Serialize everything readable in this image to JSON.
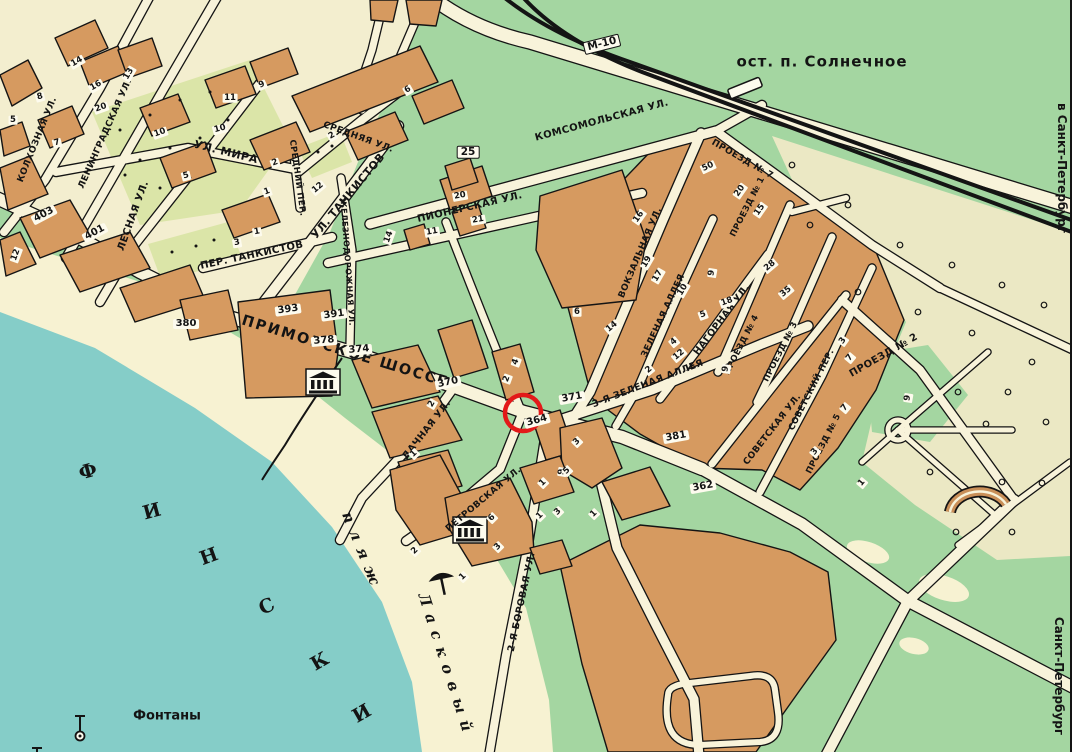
{
  "colors": {
    "land": "#a4d6a1",
    "water": "#85cdc8",
    "beach": "#f7f2d2",
    "road": "#f8f3da",
    "town": "#f3eecf",
    "park": "#ebe8c4",
    "court": "#dbe5a8",
    "building": "#d69a60",
    "outline": "#141414",
    "marker": "#e31919"
  },
  "marker": {
    "x": 523,
    "y": 413,
    "r": 18,
    "stroke_width": 4.5
  },
  "labels": [
    {
      "t": "КОЛХОЗНАЯ УЛ.",
      "x": 38,
      "y": 140,
      "r": -68,
      "st": "st",
      "s": 9
    },
    {
      "t": "ЛЕНИНГРАДСКАЯ УЛ.",
      "x": 106,
      "y": 134,
      "r": -66,
      "st": "st",
      "s": 9
    },
    {
      "t": "ЛЕСНАЯ УЛ.",
      "x": 134,
      "y": 216,
      "r": -70,
      "st": "st"
    },
    {
      "t": "УЛ. МИРА",
      "x": 226,
      "y": 152,
      "r": 14,
      "st": "st",
      "s": 11
    },
    {
      "t": "СРЕДНЯЯ УЛ.",
      "x": 358,
      "y": 138,
      "r": 20,
      "st": "st",
      "s": 9
    },
    {
      "t": "СРЕДНИЙ ПЕР.",
      "x": 297,
      "y": 178,
      "r": 82,
      "st": "st",
      "s": 8.5
    },
    {
      "t": "УЛ. ТАНКИСТОВ",
      "x": 348,
      "y": 196,
      "r": -50,
      "st": "st",
      "s": 11
    },
    {
      "t": "ПЕР. ТАНКИСТОВ",
      "x": 252,
      "y": 256,
      "r": -12,
      "st": "st"
    },
    {
      "t": "ЖЕЛЕЗНОДОРОЖНАЯ УЛ.",
      "x": 347,
      "y": 262,
      "r": 86,
      "st": "st",
      "s": 8
    },
    {
      "t": "КОМСОМОЛЬСКАЯ УЛ.",
      "x": 602,
      "y": 121,
      "r": -15,
      "st": "st"
    },
    {
      "t": "ПИОНЕРСКАЯ УЛ.",
      "x": 470,
      "y": 208,
      "r": -13,
      "st": "st"
    },
    {
      "t": "ВОКЗАЛЬНАЯ УЛ.",
      "x": 641,
      "y": 253,
      "r": -67,
      "st": "st",
      "s": 9
    },
    {
      "t": "ЗЕЛЕНАЯ АЛЛЕЯ",
      "x": 664,
      "y": 316,
      "r": -65,
      "st": "st",
      "s": 9
    },
    {
      "t": "3-Я ЗЕЛЕНАЯ АЛЛЕЯ",
      "x": 648,
      "y": 384,
      "r": -21,
      "st": "st",
      "s": 9.5
    },
    {
      "t": "НАГОРНАЯ УЛ.",
      "x": 722,
      "y": 320,
      "r": -53,
      "st": "st",
      "s": 9.5
    },
    {
      "t": "СОВЕТСКАЯ УЛ.",
      "x": 773,
      "y": 430,
      "r": -52,
      "st": "st",
      "s": 9
    },
    {
      "t": "СОВЕТСКИЙ ПЕР.",
      "x": 812,
      "y": 390,
      "r": -63,
      "st": "st",
      "s": 8.5
    },
    {
      "t": "ПРОЕЗД № 7",
      "x": 742,
      "y": 160,
      "r": 30,
      "st": "st",
      "s": 9
    },
    {
      "t": "ПРОЕЗД № 1",
      "x": 748,
      "y": 207,
      "r": -63,
      "st": "st",
      "s": 8.5
    },
    {
      "t": "ПРОЕЗД № 3",
      "x": 781,
      "y": 352,
      "r": -63,
      "st": "st",
      "s": 8.5
    },
    {
      "t": "ПРОЕЗД № 4",
      "x": 742,
      "y": 345,
      "r": -63,
      "st": "st",
      "s": 8.5
    },
    {
      "t": "ПРОЕЗД № 5",
      "x": 824,
      "y": 444,
      "r": -63,
      "st": "st",
      "s": 8.5
    },
    {
      "t": "ПРОЕЗД № 2",
      "x": 884,
      "y": 356,
      "r": -30,
      "st": "st",
      "s": 10
    },
    {
      "t": "ПРИМОРСКОЕ ШОССЕ",
      "x": 345,
      "y": 352,
      "r": 17,
      "st": "big"
    },
    {
      "t": "ДАЧНАЯ УЛ.",
      "x": 427,
      "y": 430,
      "r": -52,
      "st": "st",
      "s": 9.5
    },
    {
      "t": "ПЕТРОВСКАЯ УЛ.",
      "x": 484,
      "y": 500,
      "r": -40,
      "st": "st",
      "s": 9
    },
    {
      "t": "2-Я БОРОВАЯ УЛ.",
      "x": 522,
      "y": 602,
      "r": -78,
      "st": "st",
      "s": 9.5
    },
    {
      "t": "ост. п. Солнечное",
      "x": 822,
      "y": 62,
      "r": 0,
      "st": "stp"
    },
    {
      "t": "в Санкт-Петербург",
      "x": 1062,
      "y": 168,
      "r": 90,
      "st": "dir"
    },
    {
      "t": "Санкт-Петербург",
      "x": 1059,
      "y": 676,
      "r": 90,
      "st": "dir"
    },
    {
      "t": "Фонтаны",
      "x": 167,
      "y": 716,
      "r": 0,
      "st": "plc"
    },
    {
      "t": "пляж",
      "x": 362,
      "y": 552,
      "r": 68,
      "st": "wtr"
    },
    {
      "t": "Ласковый",
      "x": 446,
      "y": 666,
      "r": 72,
      "st": "wtr"
    },
    {
      "t": "Ф",
      "x": 88,
      "y": 472,
      "r": -15,
      "st": "glf"
    },
    {
      "t": "И",
      "x": 152,
      "y": 512,
      "r": -15,
      "st": "glf"
    },
    {
      "t": "Н",
      "x": 209,
      "y": 557,
      "r": -20,
      "st": "glf"
    },
    {
      "t": "С",
      "x": 267,
      "y": 607,
      "r": -25,
      "st": "glf"
    },
    {
      "t": "К",
      "x": 320,
      "y": 662,
      "r": -30,
      "st": "glf"
    },
    {
      "t": "И",
      "x": 362,
      "y": 714,
      "r": -30,
      "st": "glf"
    }
  ],
  "plaques": [
    [
      "380",
      186,
      324,
      0
    ],
    [
      "393",
      288,
      310,
      -8
    ],
    [
      "391",
      334,
      315,
      -8
    ],
    [
      "378",
      324,
      341,
      -5
    ],
    [
      "374",
      359,
      350,
      -5
    ],
    [
      "370",
      448,
      383,
      -12
    ],
    [
      "371",
      572,
      398,
      -10
    ],
    [
      "364",
      537,
      421,
      -15
    ],
    [
      "381",
      676,
      437,
      -10
    ],
    [
      "362",
      703,
      487,
      -10
    ],
    [
      "403",
      44,
      215,
      -28
    ],
    [
      "401",
      95,
      233,
      -28
    ]
  ],
  "badges": [
    [
      "М-10",
      602,
      44,
      -14
    ],
    [
      "25",
      468,
      152,
      0
    ]
  ],
  "numbers": [
    [
      "8",
      40,
      97,
      -15
    ],
    [
      "14",
      77,
      62,
      -30
    ],
    [
      "16",
      96,
      86,
      -30
    ],
    [
      "20",
      101,
      108,
      -20
    ],
    [
      "13",
      129,
      74,
      -60
    ],
    [
      "7",
      57,
      143,
      -15
    ],
    [
      "5",
      13,
      120,
      0
    ],
    [
      "10",
      160,
      133,
      -20
    ],
    [
      "5",
      186,
      176,
      -15
    ],
    [
      "11",
      230,
      98,
      0
    ],
    [
      "10",
      220,
      129,
      -15
    ],
    [
      "9",
      262,
      85,
      -25
    ],
    [
      "2",
      275,
      163,
      -20
    ],
    [
      "1",
      267,
      192,
      -20
    ],
    [
      "1",
      257,
      232,
      -10
    ],
    [
      "3",
      237,
      243,
      -10
    ],
    [
      "12",
      318,
      188,
      -40
    ],
    [
      "2",
      332,
      136,
      -30
    ],
    [
      "6",
      408,
      90,
      -30
    ],
    [
      "12",
      16,
      255,
      -70
    ],
    [
      "20",
      460,
      196,
      -10
    ],
    [
      "21",
      478,
      220,
      -10
    ],
    [
      "11",
      432,
      232,
      -10
    ],
    [
      "14",
      389,
      237,
      -70
    ],
    [
      "16",
      639,
      217,
      -55
    ],
    [
      "50",
      708,
      167,
      -25
    ],
    [
      "20",
      740,
      191,
      -55
    ],
    [
      "15",
      760,
      210,
      -55
    ],
    [
      "28",
      770,
      266,
      -40
    ],
    [
      "35",
      786,
      292,
      -40
    ],
    [
      "19",
      647,
      262,
      -60
    ],
    [
      "17",
      658,
      276,
      -60
    ],
    [
      "10",
      683,
      290,
      -60
    ],
    [
      "18",
      727,
      302,
      -20
    ],
    [
      "5",
      703,
      315,
      -20
    ],
    [
      "9",
      712,
      273,
      -80
    ],
    [
      "6",
      577,
      312,
      0
    ],
    [
      "14",
      612,
      327,
      -40
    ],
    [
      "4",
      674,
      342,
      -40
    ],
    [
      "12",
      679,
      355,
      -40
    ],
    [
      "2",
      649,
      370,
      -40
    ],
    [
      "9",
      726,
      369,
      -80
    ],
    [
      "7",
      850,
      358,
      -50
    ],
    [
      "7",
      845,
      408,
      -50
    ],
    [
      "9",
      908,
      398,
      -80
    ],
    [
      "3",
      815,
      452,
      -50
    ],
    [
      "1",
      862,
      483,
      -50
    ],
    [
      "3",
      843,
      341,
      -55
    ],
    [
      "3",
      577,
      442,
      -45
    ],
    [
      "9",
      562,
      472,
      -80
    ],
    [
      "1",
      540,
      516,
      -45
    ],
    [
      "1",
      594,
      514,
      -45
    ],
    [
      "2",
      432,
      404,
      -60
    ],
    [
      "1",
      414,
      454,
      -45
    ],
    [
      "4",
      516,
      362,
      -70
    ],
    [
      "2",
      507,
      379,
      -70
    ],
    [
      "2",
      415,
      551,
      -45
    ],
    [
      "1",
      463,
      577,
      -45
    ],
    [
      "3",
      498,
      547,
      -45
    ],
    [
      "6",
      492,
      518,
      -45
    ],
    [
      "3",
      558,
      512,
      -45
    ],
    [
      "1",
      543,
      483,
      -45
    ],
    [
      "5",
      567,
      471,
      -45
    ]
  ],
  "icons": [
    {
      "name": "classical-building-icon",
      "x": 305,
      "y": 368
    },
    {
      "name": "classical-building-icon",
      "x": 452,
      "y": 516
    },
    {
      "name": "beach-umbrella-icon",
      "x": 427,
      "y": 567
    },
    {
      "name": "fountain-icon",
      "x": 73,
      "y": 712
    },
    {
      "name": "fountain-icon",
      "x": 30,
      "y": 744
    }
  ]
}
